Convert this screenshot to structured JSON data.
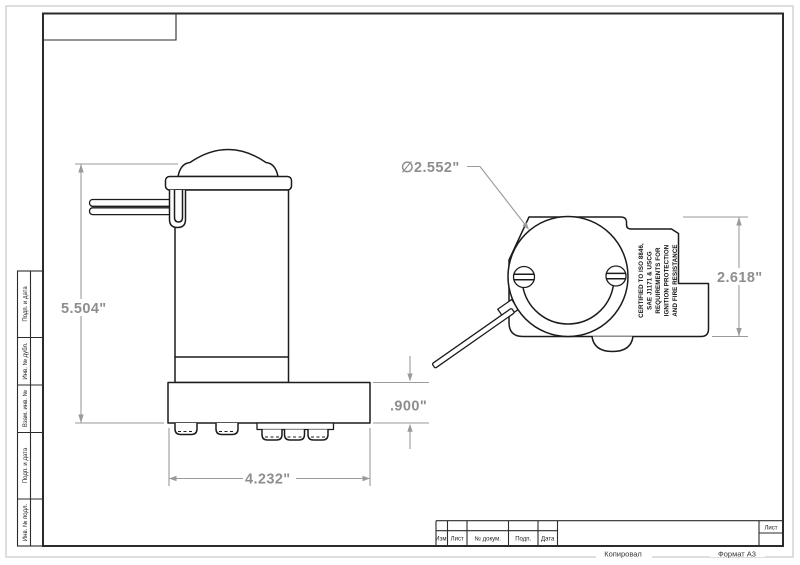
{
  "sheet": {
    "sheet_label": "Лист",
    "copied_label": "Копировал",
    "format_label": "Формат А3"
  },
  "title_block": {
    "headers": [
      "Изм.",
      "Лист",
      "№ докум.",
      "Подп.",
      "Дата"
    ]
  },
  "margin_labels": [
    "Подп. и дата",
    "Инв. № дубл.",
    "Взам. инв. №",
    "Подп. и дата",
    "Инв. № подл."
  ],
  "front_view": {
    "height_dim": "5.504\"",
    "width_dim": "4.232\"",
    "base_height_dim": ".900\""
  },
  "top_view": {
    "diameter_dim": "∅2.552\"",
    "height_dim": "2.618\"",
    "cert_lines": [
      "CERTIFIED TO ISO 8846,",
      "SAE J1171 & USCG",
      "REQUIREMENTS FOR",
      "IGNITION PROTECTION",
      "AND FIRE RESISTANCE"
    ]
  },
  "colors": {
    "outline": "#1c1c1c",
    "dimension": "#9a9a9a",
    "dim_text": "#8e8e8e",
    "frame": "#2b2b2b"
  }
}
